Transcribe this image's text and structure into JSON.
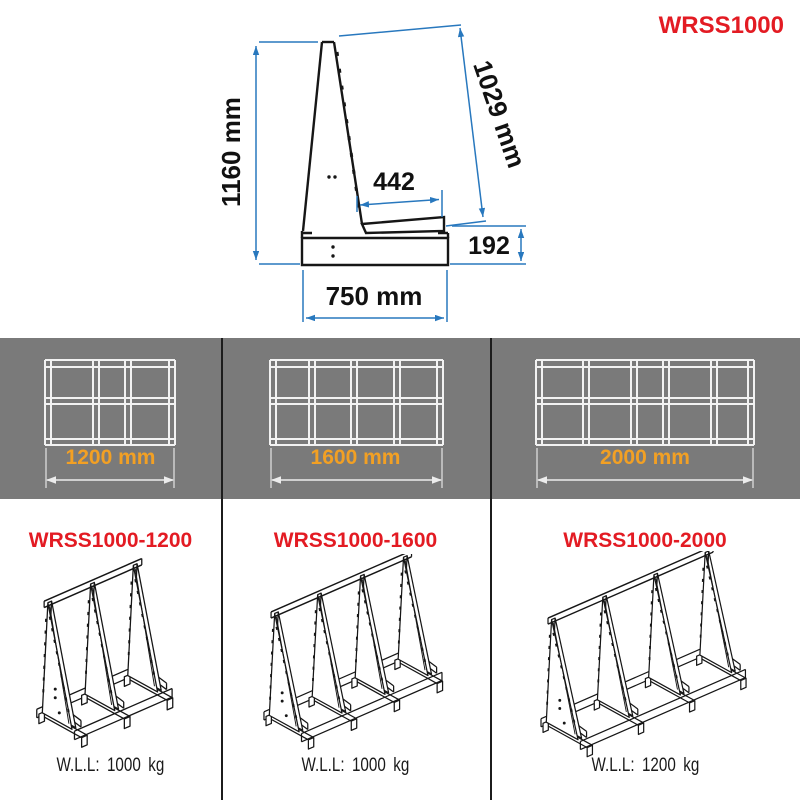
{
  "title": "WRSS1000",
  "side_view": {
    "dim_height": "1160 mm",
    "dim_slant": "1029 mm",
    "dim_shelf": "442",
    "dim_base": "192",
    "dim_width": "750 mm"
  },
  "widths_band": {
    "items": [
      {
        "label": "1200 mm"
      },
      {
        "label": "1600 mm"
      },
      {
        "label": "2000 mm"
      }
    ]
  },
  "variants": [
    {
      "model": "WRSS1000-1200",
      "wll": "W.L.L:  1000 kg"
    },
    {
      "model": "WRSS1000-1600",
      "wll": "W.L.L:  1000 kg"
    },
    {
      "model": "WRSS1000-2000",
      "wll": "W.L.L:  1200 kg"
    }
  ],
  "colors": {
    "accent_red": "#e31b23",
    "accent_orange": "#f2a024",
    "dimension_blue": "#2878be",
    "band_gray": "#7a7a7a",
    "line_black": "#161616",
    "line_white": "#f2f2f2"
  }
}
